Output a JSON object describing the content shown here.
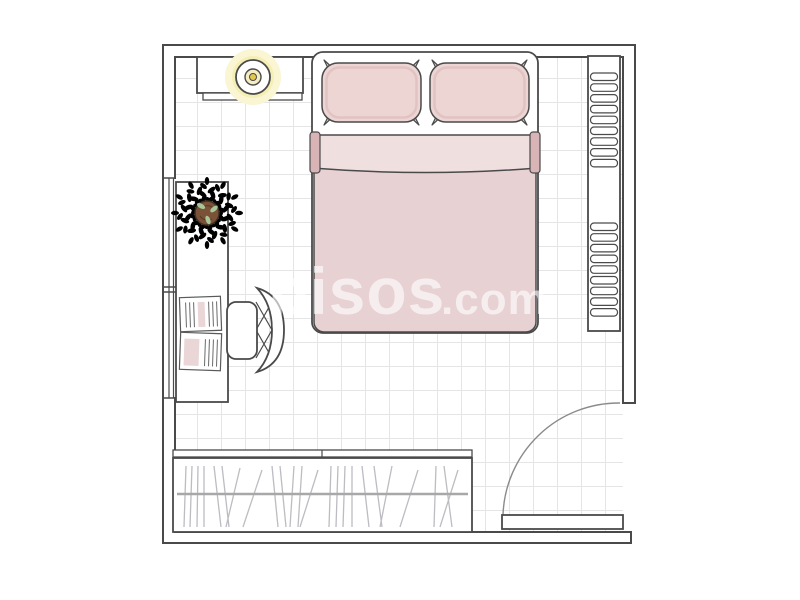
{
  "watermark": {
    "brand": "pisos",
    "suffix": ".com"
  },
  "room": {
    "type": "bedroom-floor-plan",
    "furniture": [
      "double-bed",
      "pillow-left",
      "pillow-right",
      "duvet",
      "sheet-band",
      "ceiling-light",
      "dresser",
      "radiator-shelf",
      "window",
      "desk",
      "desk-chair",
      "potted-plant",
      "open-notebook",
      "wardrobe-with-clothes",
      "door"
    ]
  },
  "colors": {
    "line": "#4a4a4a",
    "line-soft": "#8a8a8a",
    "grid": "#e5e5e8",
    "pink": "#e7d1d3",
    "pink-light": "#f0dfdf",
    "pink-dark": "#d9b4b6",
    "pillow": "#ecd5d2",
    "glow": "#f6efb5",
    "glow-soft": "#faf5d2",
    "yellow": "#e2c94e",
    "green-dark": "#5d8653",
    "green": "#7fa872",
    "green-light": "#a9c69a",
    "soil": "#7a5237",
    "clothes": "#bcbcc2",
    "rail": "#a8a8a8",
    "watermark": "rgba(255,255,255,0.62)"
  }
}
